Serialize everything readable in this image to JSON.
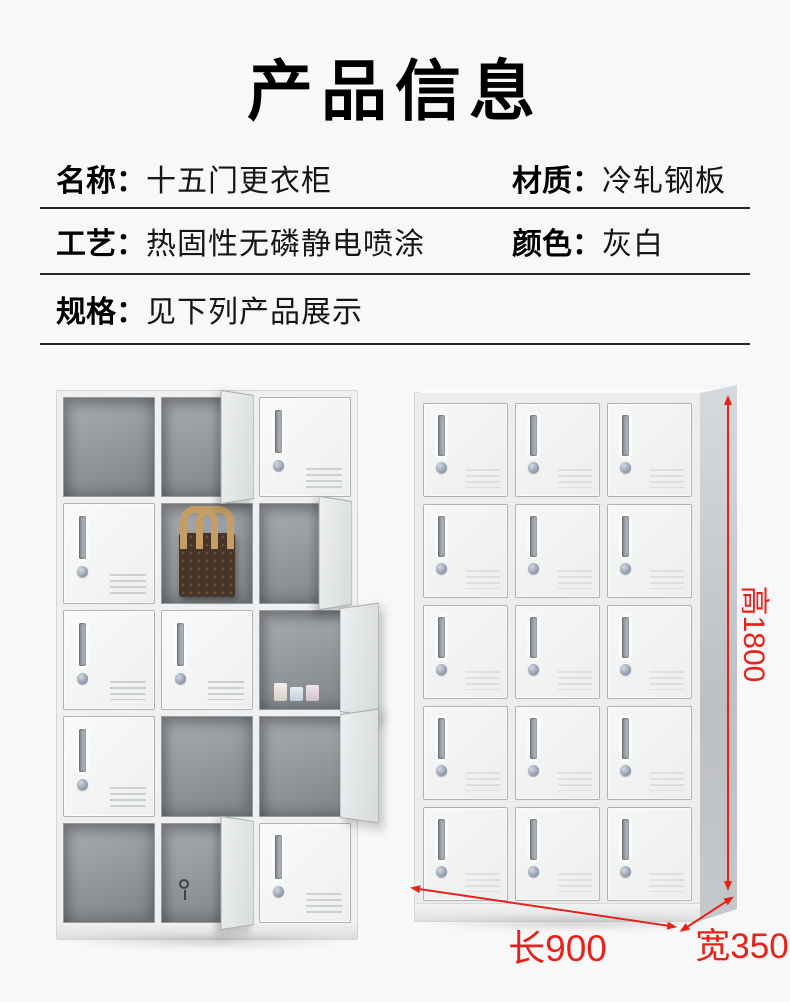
{
  "page": {
    "title": "产品信息",
    "background": "#f8f8f8",
    "accent_red": "#e5231b",
    "text_color": "#111111"
  },
  "specs": {
    "rows": [
      {
        "items": [
          {
            "label": "名称：",
            "value": "十五门更衣柜"
          },
          {
            "label": "材质：",
            "value": "冷轧钢板"
          }
        ]
      },
      {
        "items": [
          {
            "label": "工艺：",
            "value": "热固性无磷静电喷涂"
          },
          {
            "label": "颜色：",
            "value": "灰白"
          }
        ]
      },
      {
        "items": [
          {
            "label": "规格：",
            "value": "见下列产品展示"
          }
        ]
      }
    ]
  },
  "showcase": {
    "left_locker": {
      "description": "fifteen-door locker photo, several doors open, brown handbag inside one compartment",
      "rows": 5,
      "cols": 3,
      "cells": [
        "open-interior",
        "open-door",
        "closed",
        "closed",
        "open-bag",
        "open-door",
        "closed",
        "closed",
        "open-items-out",
        "closed",
        "open-interior",
        "open-door-out",
        "open-interior",
        "open-door-keys",
        "closed"
      ]
    },
    "right_locker": {
      "description": "fifteen-door locker photo, all doors closed, with dimension arrows",
      "rows": 5,
      "cols": 3,
      "cells": [
        "closed",
        "closed",
        "closed",
        "closed",
        "closed",
        "closed",
        "closed",
        "closed",
        "closed",
        "closed",
        "closed",
        "closed",
        "closed",
        "closed",
        "closed"
      ]
    },
    "dimensions": {
      "height": "高1800",
      "length": "长900",
      "width": "宽350"
    }
  }
}
